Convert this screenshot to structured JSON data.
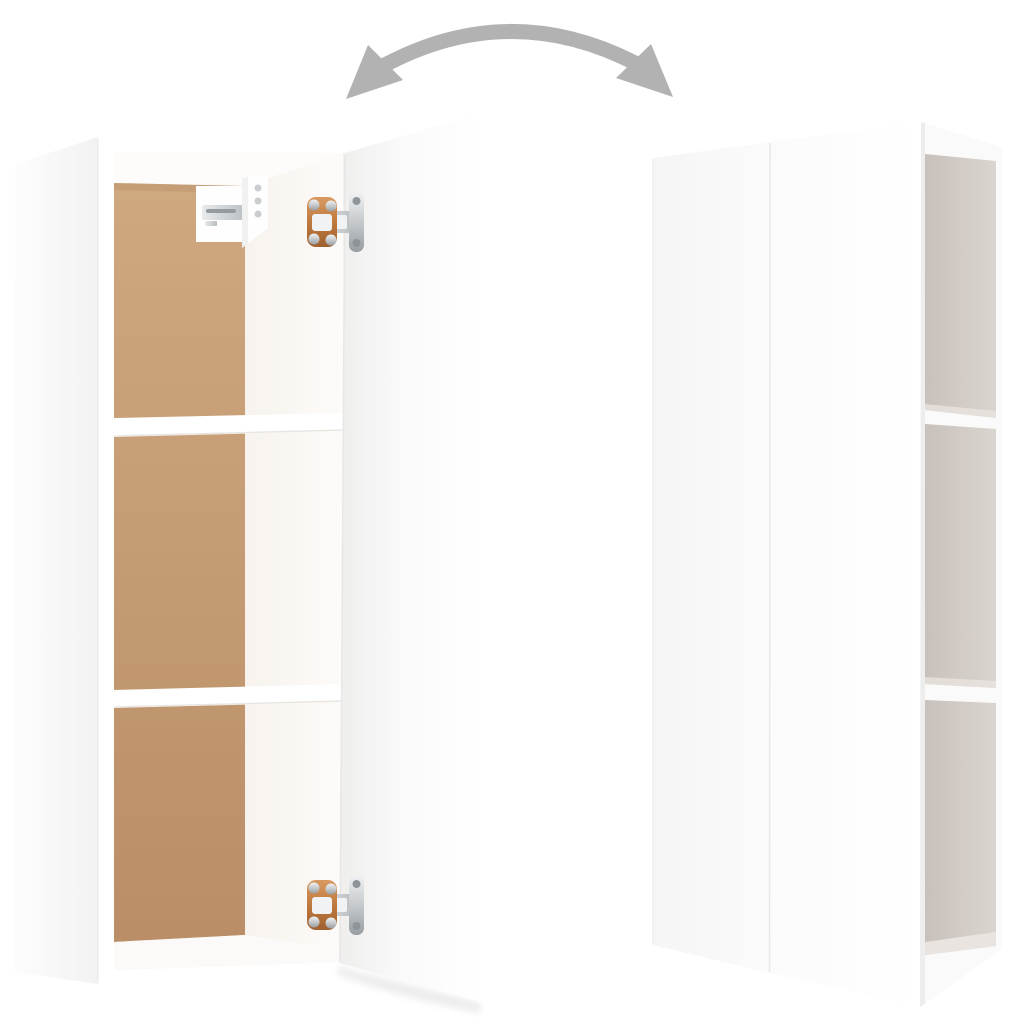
{
  "scene": {
    "alt": "White wall cabinet shown open with two shelves, mounting bracket and two hinges (left) and the same cabinet closed, seen from the side with three open niches (right), linked by a curved double-headed rotation arrow"
  },
  "arrow": {
    "icon": "rotate-both-ways-arrow-icon",
    "color": "#b2b2b2"
  },
  "palette": {
    "white": "#ffffff",
    "panel_light": "#fdfdfd",
    "panel_shade": "#f2f2f2",
    "edge_line": "#e7e7e7",
    "interior_shadow": "#eee6df",
    "interior_warm": "#f7f2ed",
    "interior_bright": "#fdfbf9",
    "ceiling": "#fdfcfa",
    "back_top": "#cfa87f",
    "back_bottom": "#ba8e66",
    "back_edge_shadow": "#a8805c",
    "shelf_white": "#ffffff",
    "shelf_edge": "#e9e6e2",
    "floor_white": "#fcfaf8",
    "door_edge": "#efeeed",
    "door_mid": "#fafafa",
    "front_left_dark": "#f5f5f5",
    "front_left_light": "#fbfbfb",
    "front_right_light": "#ffffff",
    "seam": "#e8e8e8",
    "side_face": "#fbfafa",
    "niche_dark": "#c8c1bb",
    "niche_light": "#dbd5d0",
    "niche_floor": "#e9e4df",
    "shadow_soft": "#dedede",
    "metal_hi": "#f0f2f3",
    "metal_mid": "#c6cacd",
    "metal_low": "#979da1",
    "metal_h1": "#e9ebec",
    "metal_h2": "#b7bcc0",
    "copper_hi": "#d89a62",
    "copper_mid": "#c07a3e",
    "copper_low": "#9f6130",
    "screw": "#8e9498",
    "bracket_white": "#fefefe",
    "hole_gray": "#c9cdd0",
    "slot_dark": "#959ba0"
  }
}
